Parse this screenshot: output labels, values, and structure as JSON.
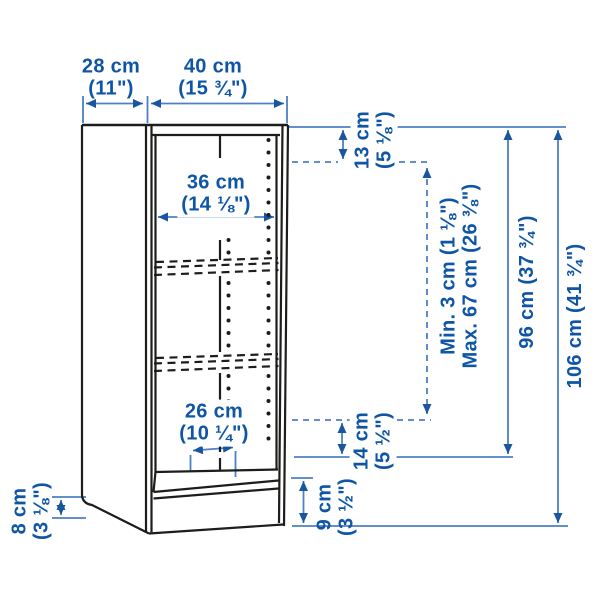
{
  "colors": {
    "dimension_text": "#0e55a6",
    "dimension_line": "#4d80c2",
    "arrowhead": "#1a55a0",
    "drawing_line": "#1d1d1b",
    "background": "#ffffff"
  },
  "labels": {
    "depth": {
      "cm": "28 cm",
      "in": "(11\")"
    },
    "width": {
      "cm": "40 cm",
      "in": "(15 ¾\")"
    },
    "inner_width": {
      "cm": "36 cm",
      "in": "(14 ⅛\")"
    },
    "top_shelf_gap": {
      "cm": "13 cm",
      "in": "(5 ⅛\")"
    },
    "shelf_spacing": {
      "min": "Min. 3 cm (1 ⅛\")",
      "max": "Max. 67 cm (26 ⅜\")"
    },
    "inner_height": {
      "full": "96 cm (37 ¾\")"
    },
    "total_height": {
      "full": "106 cm (41 ¾\")"
    },
    "inner_depth": {
      "cm": "26 cm",
      "in": "(10 ¼\")"
    },
    "bottom_shelf_gap": {
      "cm": "14 cm",
      "in": "(5 ½\")"
    },
    "plinth_height": {
      "cm": "9 cm",
      "in": "(3 ½\")"
    },
    "skirting_cutout": {
      "cm": "8 cm",
      "in": "(3 ⅛\")"
    }
  }
}
